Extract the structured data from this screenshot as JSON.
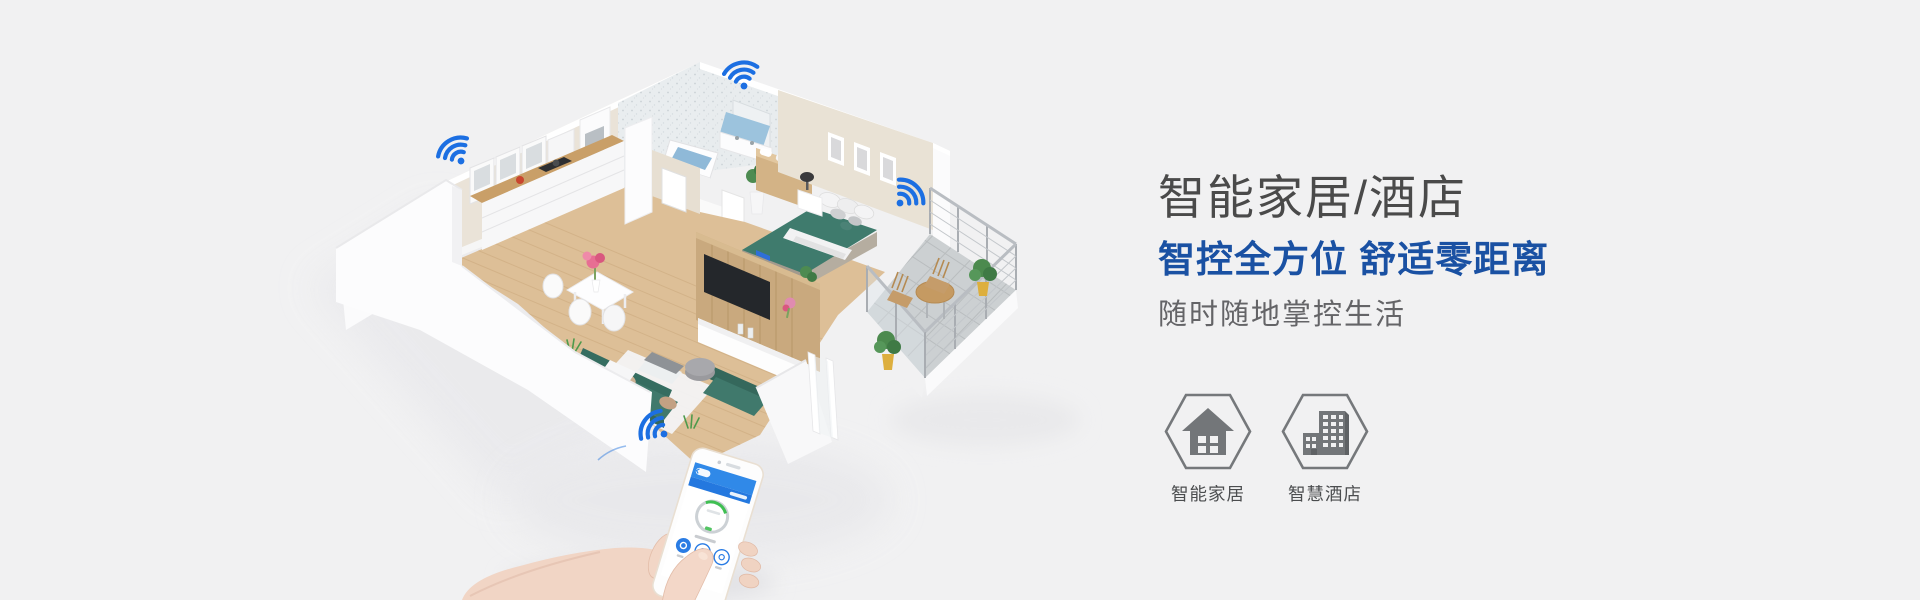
{
  "page": {
    "background": "#f1f1f2"
  },
  "hero": {
    "title": "智能家居/酒店",
    "headline": "智控全方位 舒适零距离",
    "subtitle": "随时随地掌控生活",
    "title_color": "#4a4a4a",
    "headline_color": "#1a51a3",
    "subtitle_color": "#646467"
  },
  "features": [
    {
      "label": "智能家居",
      "icon": "house-icon"
    },
    {
      "label": "智慧酒店",
      "icon": "buildings-icon"
    }
  ],
  "illustration": {
    "description": "isometric smart apartment with four wifi hotspots and a hand holding a smartphone control app",
    "wifi_color": "#1c6fe2",
    "wifi_count": 4,
    "sofa_color": "#40796c",
    "bed_color": "#3f7b6d",
    "wood_color": "#ddbf97",
    "app_accent_color": "#2a7ce4"
  }
}
